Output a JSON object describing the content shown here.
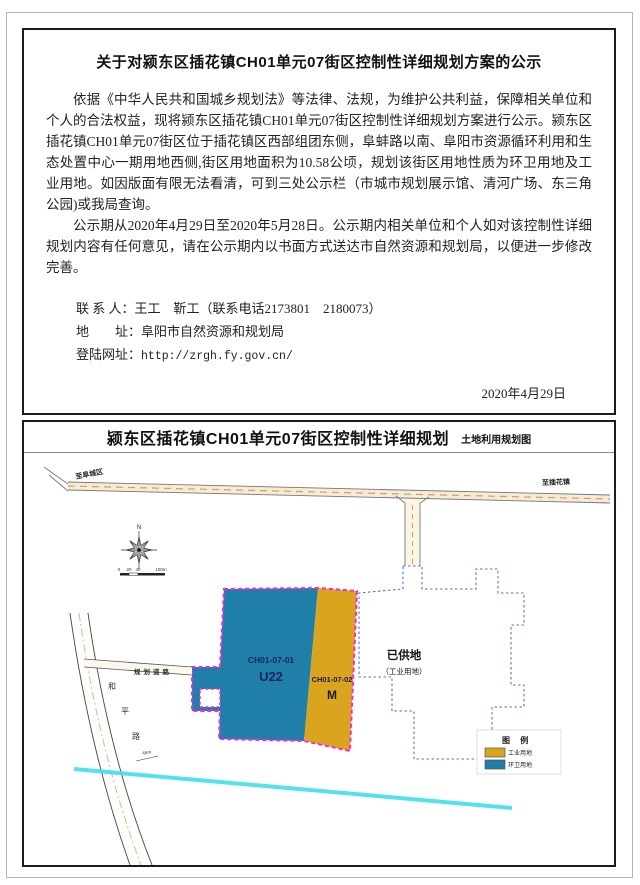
{
  "notice": {
    "title": "关于对颍东区插花镇CH01单元07街区控制性详细规划方案的公示",
    "paragraph1": "依据《中华人民共和国城乡规划法》等法律、法规，为维护公共利益，保障相关单位和个人的合法权益，现将颍东区插花镇CH01单元07街区控制性详细规划方案进行公示。颍东区插花镇CH01单元07街区位于插花镇区西部组团东侧，阜蚌路以南、阜阳市资源循环利用和生态处置中心一期用地西侧,街区用地面积为10.58公顷，规划该街区用地性质为环卫用地及工业用地。如因版面有限无法看清，可到三处公示栏（市城市规划展示馆、清河广场、东三角公园)或我局查询。",
    "paragraph2": "公示期从2020年4月29日至2020年5月28日。公示期内相关单位和个人如对该控制性详细规划内容有任何意见，请在公示期内以书面方式送达市自然资源和规划局，以便进一步修改完善。",
    "contact": {
      "label": "联 系 人：",
      "value": "王工　靳工（联系电话2173801　2180073）"
    },
    "address": {
      "label": "地　　址：",
      "value": "阜阳市自然资源和规划局"
    },
    "website": {
      "label": "登陆网址：",
      "value": "http://zrgh.fy.gov.cn/"
    },
    "date": "2020年4月29日"
  },
  "map": {
    "title": "颍东区插花镇CH01单元07街区控制性详细规划",
    "subtitle": "土地利用规划图",
    "compass_label": "N",
    "scale_ticks": [
      "0",
      "20",
      "40",
      "100m"
    ],
    "roads": {
      "top_left_label": "至阜城区",
      "top_right_label": "至插花镇",
      "heping_chars": [
        "和",
        "平",
        "路"
      ],
      "planned_label": "规划道路",
      "width_note": "45m"
    },
    "zones": {
      "sanitation": {
        "code": "CH01-07-01",
        "use_code": "U22",
        "color": "#1f7fa8",
        "label_color": "#14265a"
      },
      "industrial": {
        "code": "CH01-07-02",
        "use_code": "M",
        "color": "#d9a51e",
        "label_color": "#1a1a3a"
      },
      "supplied": {
        "name": "已供地",
        "note": "（工业用地）"
      }
    },
    "legend": {
      "title": "图  例",
      "items": [
        {
          "label": "工业用地",
          "color": "#d9a51e"
        },
        {
          "label": "环卫用地",
          "color": "#1f7fa8"
        }
      ]
    },
    "boundary_color": "#ff22dd",
    "supplied_outline_color": "#5a6fd4",
    "river_color": "#3fe0e8"
  }
}
